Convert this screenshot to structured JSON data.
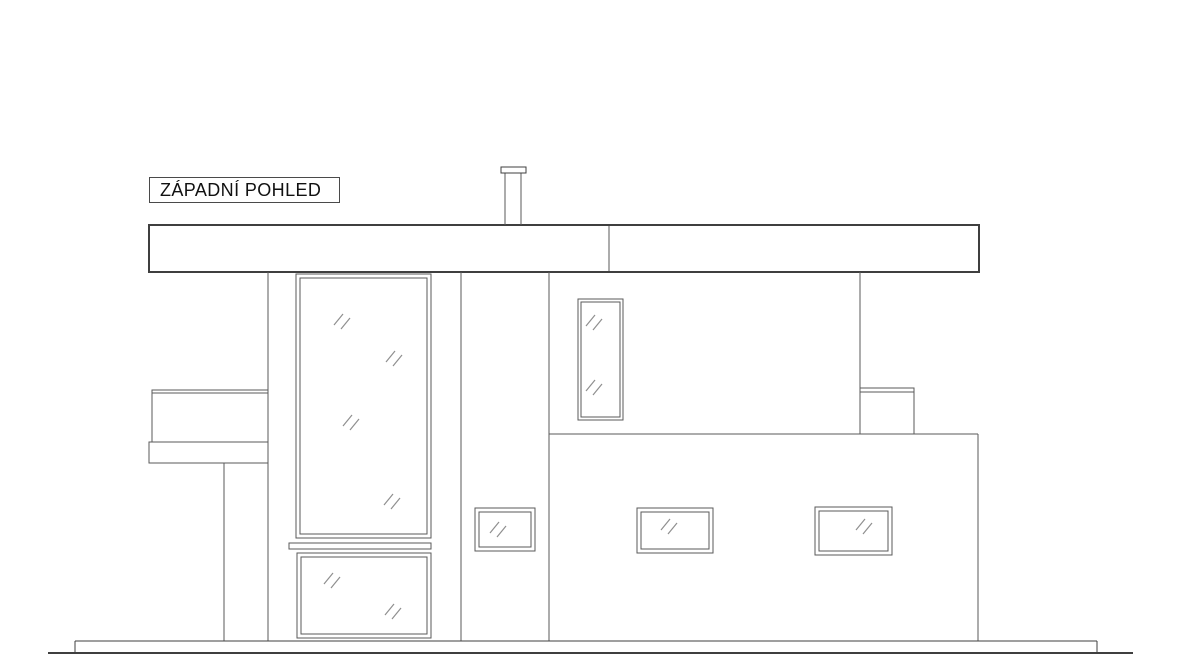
{
  "title_box": {
    "label": "ZÁPADNÍ POHLED"
  },
  "colors": {
    "background": "#ffffff",
    "line_dark": "#3f3f3f",
    "line_mid": "#5a5a5a",
    "glass_mark": "#8f8f8f",
    "title_text": "#111111",
    "title_border": "#4a4a4a"
  },
  "drawing": {
    "width": 1180,
    "height": 664,
    "ground": {
      "top_line": {
        "x1": 75,
        "y1": 641,
        "x2": 1097,
        "y2": 641
      },
      "bottom_line": {
        "x1": 48,
        "y1": 653,
        "x2": 1133,
        "y2": 653
      },
      "left_tick": {
        "x1": 75,
        "y1": 641,
        "x2": 75,
        "y2": 653
      },
      "right_tick": {
        "x1": 1097,
        "y1": 641,
        "x2": 1097,
        "y2": 653
      }
    },
    "roof": {
      "rect": [
        149,
        225,
        830,
        47
      ],
      "divider_x": 609
    },
    "chimney": {
      "cap": [
        501,
        167,
        25,
        6
      ],
      "shaft_left_x": 505,
      "shaft_right_x": 521,
      "top_y": 173,
      "bottom_y": 225
    },
    "wall_lines": [
      {
        "name": "left-wall-edge",
        "x1": 268,
        "y1": 272,
        "x2": 268,
        "y2": 641
      },
      {
        "name": "left-porch-column-edge",
        "x1": 224,
        "y1": 463,
        "x2": 224,
        "y2": 641
      },
      {
        "name": "center-column-left-edge",
        "x1": 461,
        "y1": 272,
        "x2": 461,
        "y2": 641
      },
      {
        "name": "center-column-right-edge",
        "x1": 549,
        "y1": 272,
        "x2": 549,
        "y2": 641
      },
      {
        "name": "upper-wall-right-edge",
        "x1": 860,
        "y1": 272,
        "x2": 860,
        "y2": 434
      },
      {
        "name": "lower-body-top-edge",
        "x1": 549,
        "y1": 434,
        "x2": 978,
        "y2": 434
      },
      {
        "name": "lower-body-right-edge",
        "x1": 978,
        "y1": 434,
        "x2": 978,
        "y2": 641
      }
    ],
    "balcony_left": {
      "parapet": [
        152,
        390,
        116,
        52
      ],
      "parapet_inner_top_y": 393,
      "slab": [
        149,
        442,
        119,
        21
      ]
    },
    "balcony_right": {
      "parapet": [
        860,
        388,
        54,
        46
      ],
      "parapet_inner_top_y": 392
    },
    "window_sill": {
      "rect": [
        289,
        543,
        142,
        6
      ]
    },
    "windows": [
      {
        "name": "window-large-upper",
        "outer": [
          296,
          274,
          135,
          264
        ],
        "inset": 4,
        "marks": [
          [
            342,
            321
          ],
          [
            394,
            358
          ],
          [
            351,
            422
          ],
          [
            392,
            501
          ]
        ]
      },
      {
        "name": "window-large-lower",
        "outer": [
          297,
          553,
          134,
          85
        ],
        "inset": 4,
        "marks": [
          [
            332,
            580
          ],
          [
            393,
            611
          ]
        ]
      },
      {
        "name": "window-column-small",
        "outer": [
          475,
          508,
          60,
          43
        ],
        "inset": 4,
        "marks": [
          [
            498,
            529
          ]
        ]
      },
      {
        "name": "window-narrow-upper",
        "outer": [
          578,
          299,
          45,
          121
        ],
        "inset": 3,
        "marks": [
          [
            594,
            322
          ],
          [
            594,
            387
          ]
        ]
      },
      {
        "name": "window-lower-middle",
        "outer": [
          637,
          508,
          76,
          45
        ],
        "inset": 4,
        "marks": [
          [
            669,
            526
          ]
        ]
      },
      {
        "name": "window-lower-right",
        "outer": [
          815,
          507,
          77,
          48
        ],
        "inset": 4,
        "marks": [
          [
            864,
            526
          ]
        ]
      }
    ]
  }
}
